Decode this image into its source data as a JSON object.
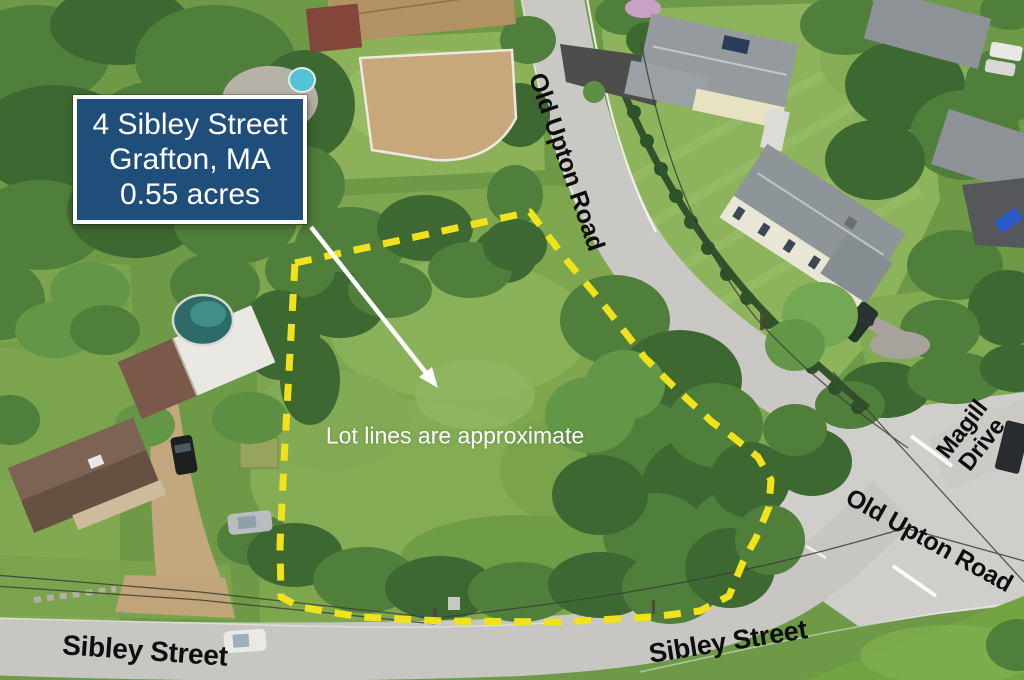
{
  "listing": {
    "address_line1": "4 Sibley Street",
    "address_line2": "Grafton, MA",
    "lot_size": "0.55 acres"
  },
  "overlay": {
    "disclaimer": "Lot lines are approximate"
  },
  "road_labels": {
    "old_upton_top": "Old Upton Road",
    "old_upton_lower": "Old Upton Road",
    "magill_line1": "Magill",
    "magill_line2": "Drive",
    "sibley_west": "Sibley Street",
    "sibley_east": "Sibley Street"
  },
  "colors": {
    "info_box_bg": "#1f4e7b",
    "info_box_border": "#ffffff",
    "info_box_text": "#ffffff",
    "lot_boundary": "#f2e21c",
    "road_label": "#0d0d0d",
    "disclaimer_text": "#ffffff",
    "arrow": "#ffffff",
    "road_surface": "#c9c8c4",
    "meadow": "#7da64f"
  }
}
